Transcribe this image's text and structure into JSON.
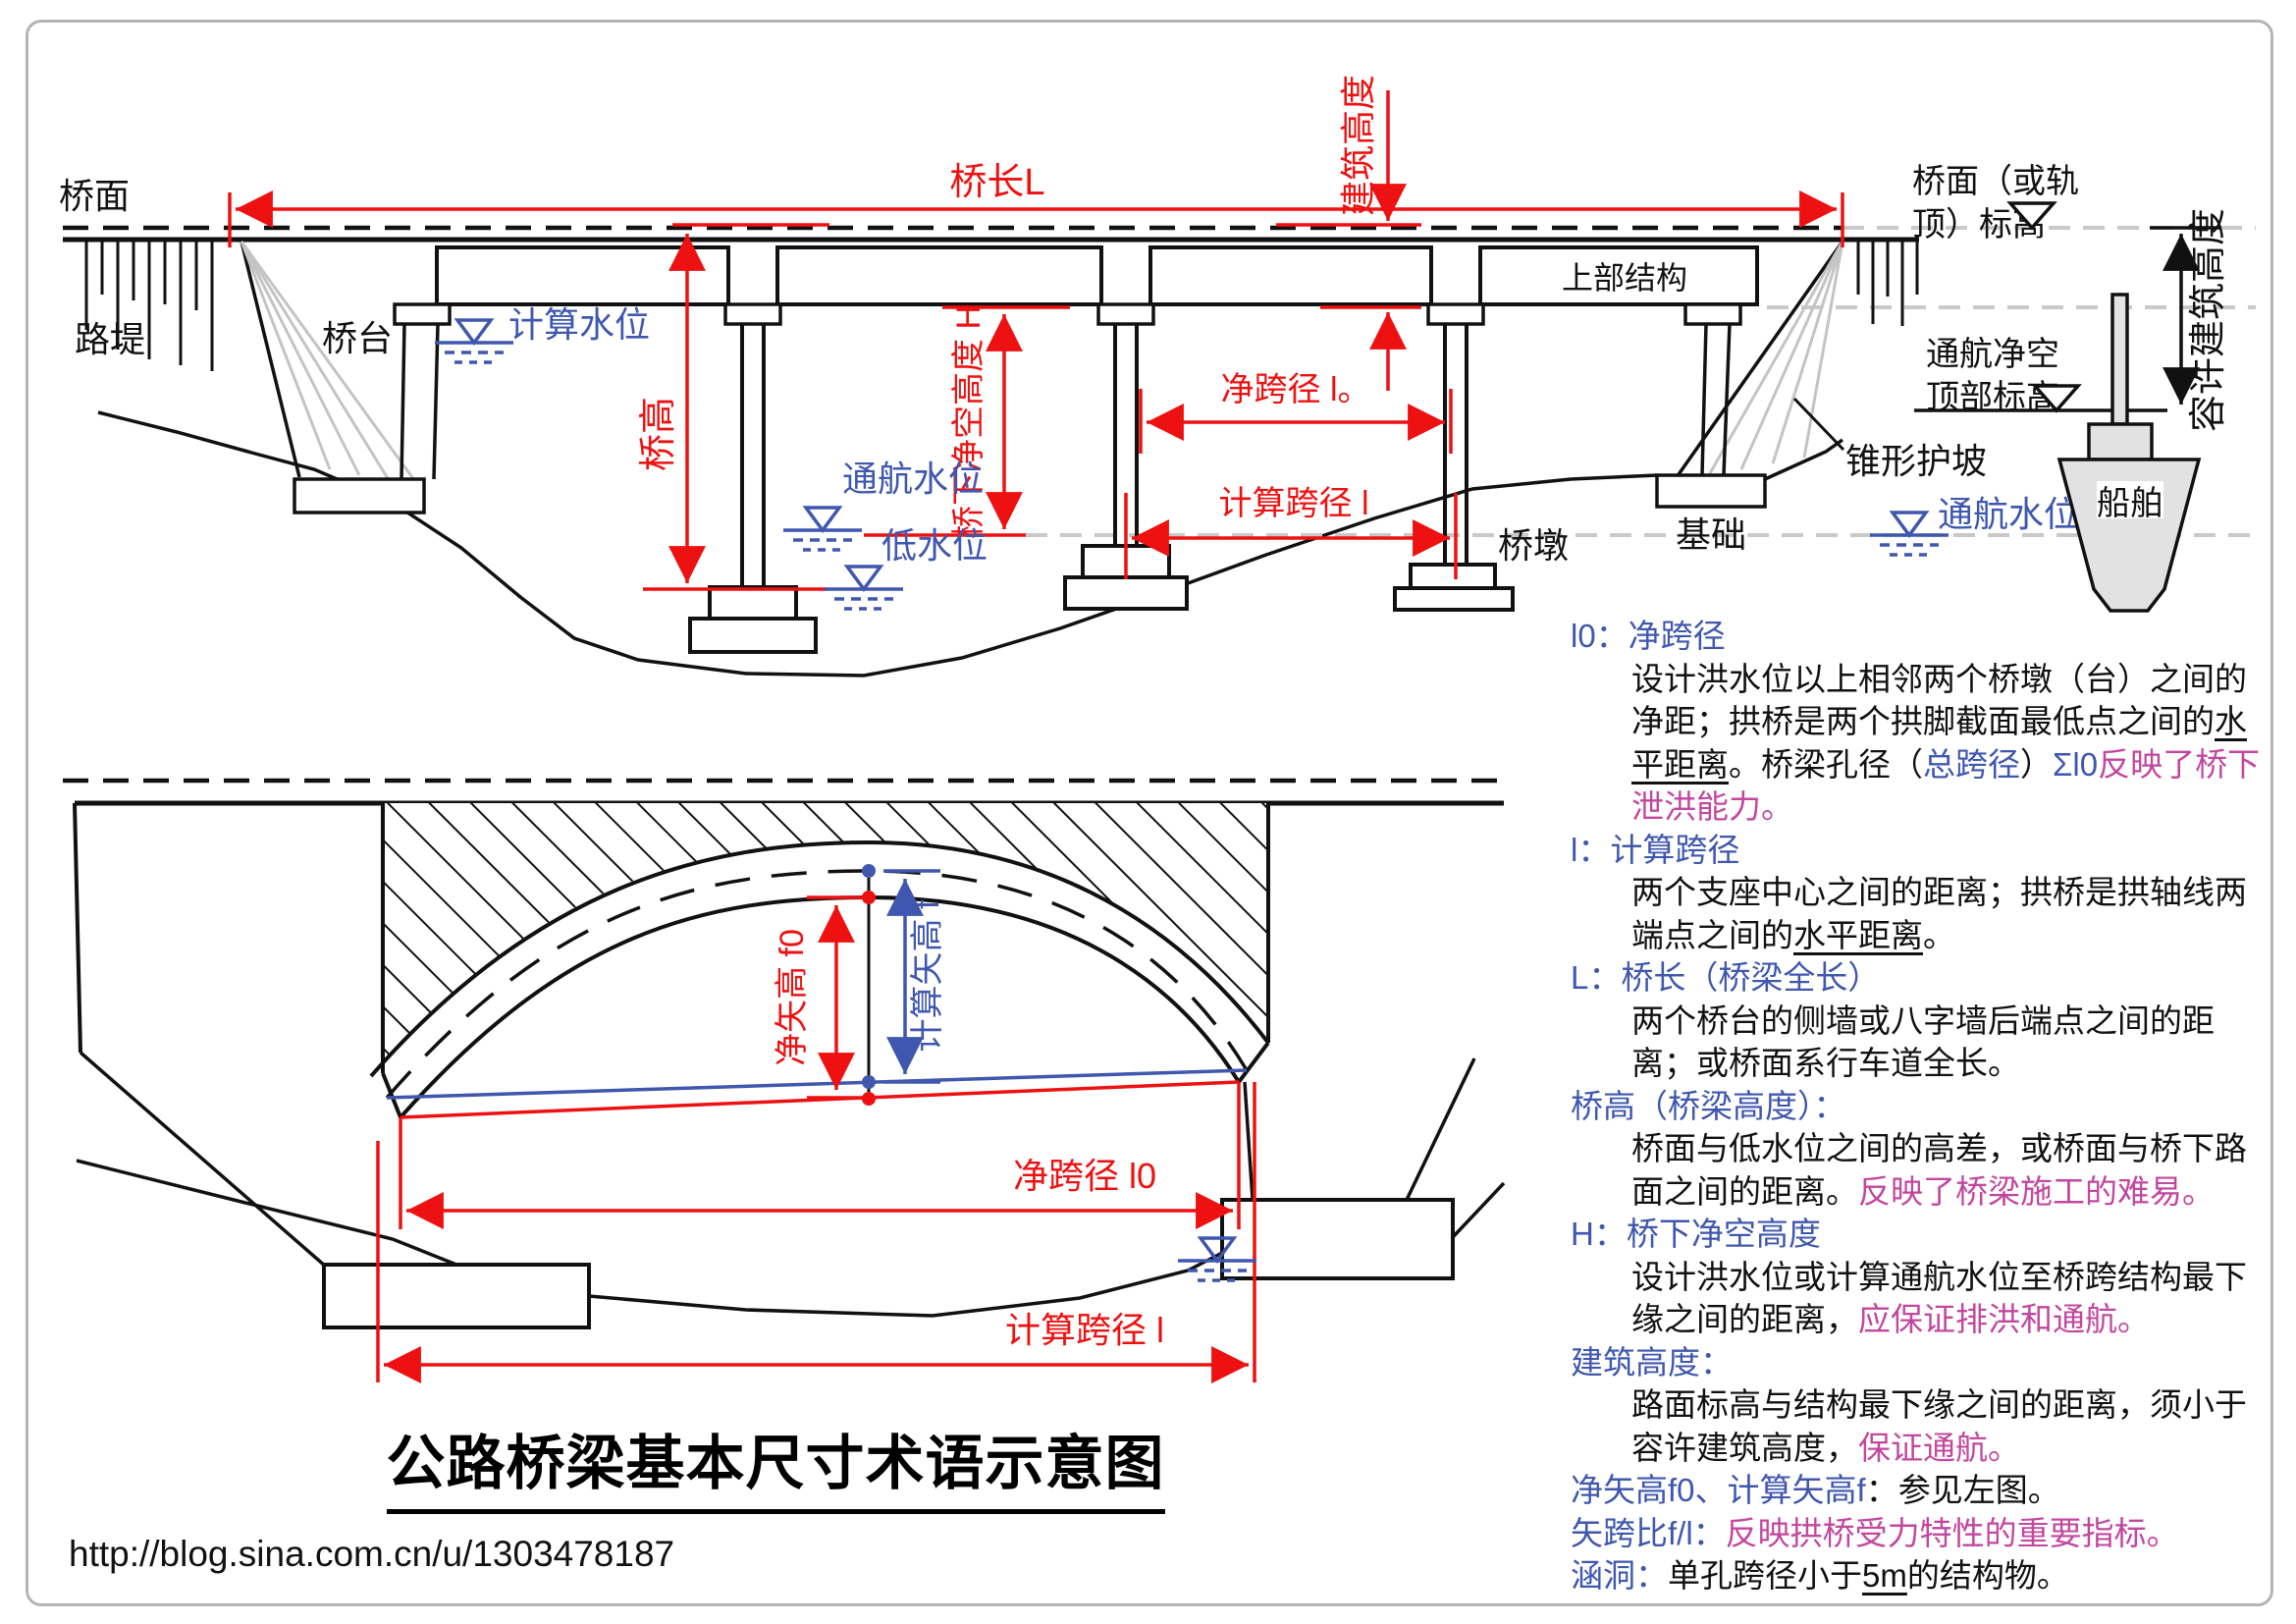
{
  "colors": {
    "red": "#ee1111",
    "blue": "#3f57ae",
    "magenta": "#c2479e",
    "gray_dash": "#c9c9c9",
    "ship_fill": "#e2e2e2"
  },
  "top_diagram": {
    "deck_label": "桥面",
    "embankment_label": "路堤",
    "abutment_label": "桥台",
    "calc_water_level": "计算水位",
    "bridge_length": "桥长L",
    "construction_height": "建筑高度",
    "superstructure": "上部结构",
    "clear_span": "净跨径 l。",
    "calc_span": "计算跨径 l",
    "bridge_height": "桥高",
    "under_clearance": "桥下净空高度 H",
    "nav_water_level": "通航水位",
    "low_water_level": "低水位",
    "pier_label": "桥墩",
    "foundation_label": "基础",
    "deck_elev_line1": "桥面（或轨",
    "deck_elev_line2": "顶）标高",
    "nav_clear_line1": "通航净空",
    "nav_clear_line2": "顶部标高",
    "allowed_height": "容许建筑高度",
    "cone_slope": "锥形护坡",
    "nav_water_level_right": "通航水位",
    "ship": "船舶"
  },
  "bottom_diagram": {
    "net_rise": "净矢高 f0",
    "calc_rise": "计算矢高 f",
    "clear_span": "净跨径 l0",
    "calc_span": "计算跨径 l"
  },
  "title": "公路桥梁基本尺寸术语示意图",
  "url": "http://blog.sina.com.cn/u/1303478187",
  "definitions": [
    {
      "indent": false,
      "segments": [
        {
          "t": "l0：净跨径",
          "c": "b"
        }
      ]
    },
    {
      "indent": true,
      "segments": [
        {
          "t": "设计洪水位以上相邻两个桥墩（台）之间的",
          "c": "k"
        }
      ]
    },
    {
      "indent": true,
      "segments": [
        {
          "t": "净距；拱桥是两个拱脚截面最低点之间的",
          "c": "k"
        },
        {
          "t": "水",
          "c": "k",
          "u": true
        }
      ]
    },
    {
      "indent": true,
      "segments": [
        {
          "t": "平距离",
          "c": "k",
          "u": true
        },
        {
          "t": "。桥梁孔径（",
          "c": "k"
        },
        {
          "t": "总跨径",
          "c": "b"
        },
        {
          "t": "）",
          "c": "k"
        },
        {
          "t": "Σl0",
          "c": "b"
        },
        {
          "t": "反映了桥下",
          "c": "m"
        }
      ]
    },
    {
      "indent": true,
      "segments": [
        {
          "t": "泄洪能力。",
          "c": "m"
        }
      ]
    },
    {
      "indent": false,
      "segments": [
        {
          "t": "l：计算跨径",
          "c": "b"
        }
      ]
    },
    {
      "indent": true,
      "segments": [
        {
          "t": "两个支座中心之间的距离；拱桥是拱轴线两",
          "c": "k"
        }
      ]
    },
    {
      "indent": true,
      "segments": [
        {
          "t": "端点之间的",
          "c": "k"
        },
        {
          "t": "水平距离",
          "c": "k",
          "u": true
        },
        {
          "t": "。",
          "c": "k"
        }
      ]
    },
    {
      "indent": false,
      "segments": [
        {
          "t": "L：桥长（桥梁全长）",
          "c": "b"
        }
      ]
    },
    {
      "indent": true,
      "segments": [
        {
          "t": "两个桥台的侧墙或八字墙后端点之间的距",
          "c": "k"
        }
      ]
    },
    {
      "indent": true,
      "segments": [
        {
          "t": "离；或桥面系行车道全长。",
          "c": "k"
        }
      ]
    },
    {
      "indent": false,
      "segments": [
        {
          "t": "桥高（桥梁高度）：",
          "c": "b"
        }
      ]
    },
    {
      "indent": true,
      "segments": [
        {
          "t": "桥面与低水位之间的高差，或桥面与桥下路",
          "c": "k"
        }
      ]
    },
    {
      "indent": true,
      "segments": [
        {
          "t": "面之间的距离。",
          "c": "k"
        },
        {
          "t": "反映了桥梁施工的难易。",
          "c": "m"
        }
      ]
    },
    {
      "indent": false,
      "segments": [
        {
          "t": "H：桥下净空高度",
          "c": "b"
        }
      ]
    },
    {
      "indent": true,
      "segments": [
        {
          "t": "设计洪水位或计算通航水位至桥跨结构最下",
          "c": "k"
        }
      ]
    },
    {
      "indent": true,
      "segments": [
        {
          "t": "缘之间的距离，",
          "c": "k"
        },
        {
          "t": "应保证排洪和通航。",
          "c": "m"
        }
      ]
    },
    {
      "indent": false,
      "segments": [
        {
          "t": "建筑高度：",
          "c": "b"
        }
      ]
    },
    {
      "indent": true,
      "segments": [
        {
          "t": "路面标高与结构最下缘之间的距离，须小于",
          "c": "k"
        }
      ]
    },
    {
      "indent": true,
      "segments": [
        {
          "t": "容许建筑高度，",
          "c": "k"
        },
        {
          "t": "保证通航。",
          "c": "m"
        }
      ]
    },
    {
      "indent": false,
      "segments": [
        {
          "t": "净矢高f0、计算矢高f",
          "c": "b"
        },
        {
          "t": "：参见左图。",
          "c": "k"
        }
      ]
    },
    {
      "indent": false,
      "segments": [
        {
          "t": "矢跨比f/l：",
          "c": "b"
        },
        {
          "t": "反映拱桥受力特性的重要指标。",
          "c": "m"
        }
      ]
    },
    {
      "indent": false,
      "segments": [
        {
          "t": "涵洞：",
          "c": "b"
        },
        {
          "t": "单孔跨径小于",
          "c": "k"
        },
        {
          "t": "5m",
          "c": "k",
          "u": true
        },
        {
          "t": "的结构物。",
          "c": "k"
        }
      ]
    }
  ]
}
